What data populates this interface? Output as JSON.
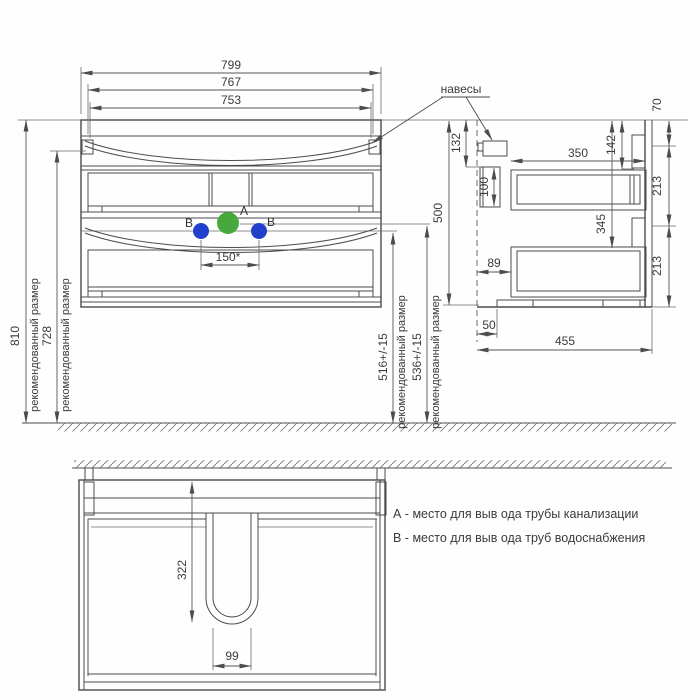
{
  "colors": {
    "line": "#4c4c4c",
    "drain_green": "#47a83e",
    "water_blue": "#2240cc"
  },
  "front_view": {
    "width_total": "799",
    "width_inner": "767",
    "width_basin": "753",
    "height_total": "810",
    "height_hanger": "728",
    "rec_size_label": "рекомендованный размер",
    "water_spacing": "150*",
    "height_water": "516+/-15",
    "height_drain": "536+/-15",
    "point_a": "A",
    "point_b_left": "B",
    "point_b_right": "B"
  },
  "side_view": {
    "hangers_label": "навесы",
    "hanger_height": "132",
    "bracket_height": "100",
    "drawer_depth": "350",
    "total_height": "500",
    "top_inset": "142",
    "drawer2_offset": "345",
    "top_rail": "70",
    "drawer_front_upper": "213",
    "drawer_front_lower": "213",
    "wall_gap": "89",
    "foot_inset": "50",
    "total_depth": "455"
  },
  "bottom_view": {
    "siphon_depth": "322",
    "siphon_width": "99"
  },
  "legend": {
    "point_a": "А - место для выв ода трубы канализации",
    "point_b": "В - место для выв ода труб водоснабжения"
  }
}
